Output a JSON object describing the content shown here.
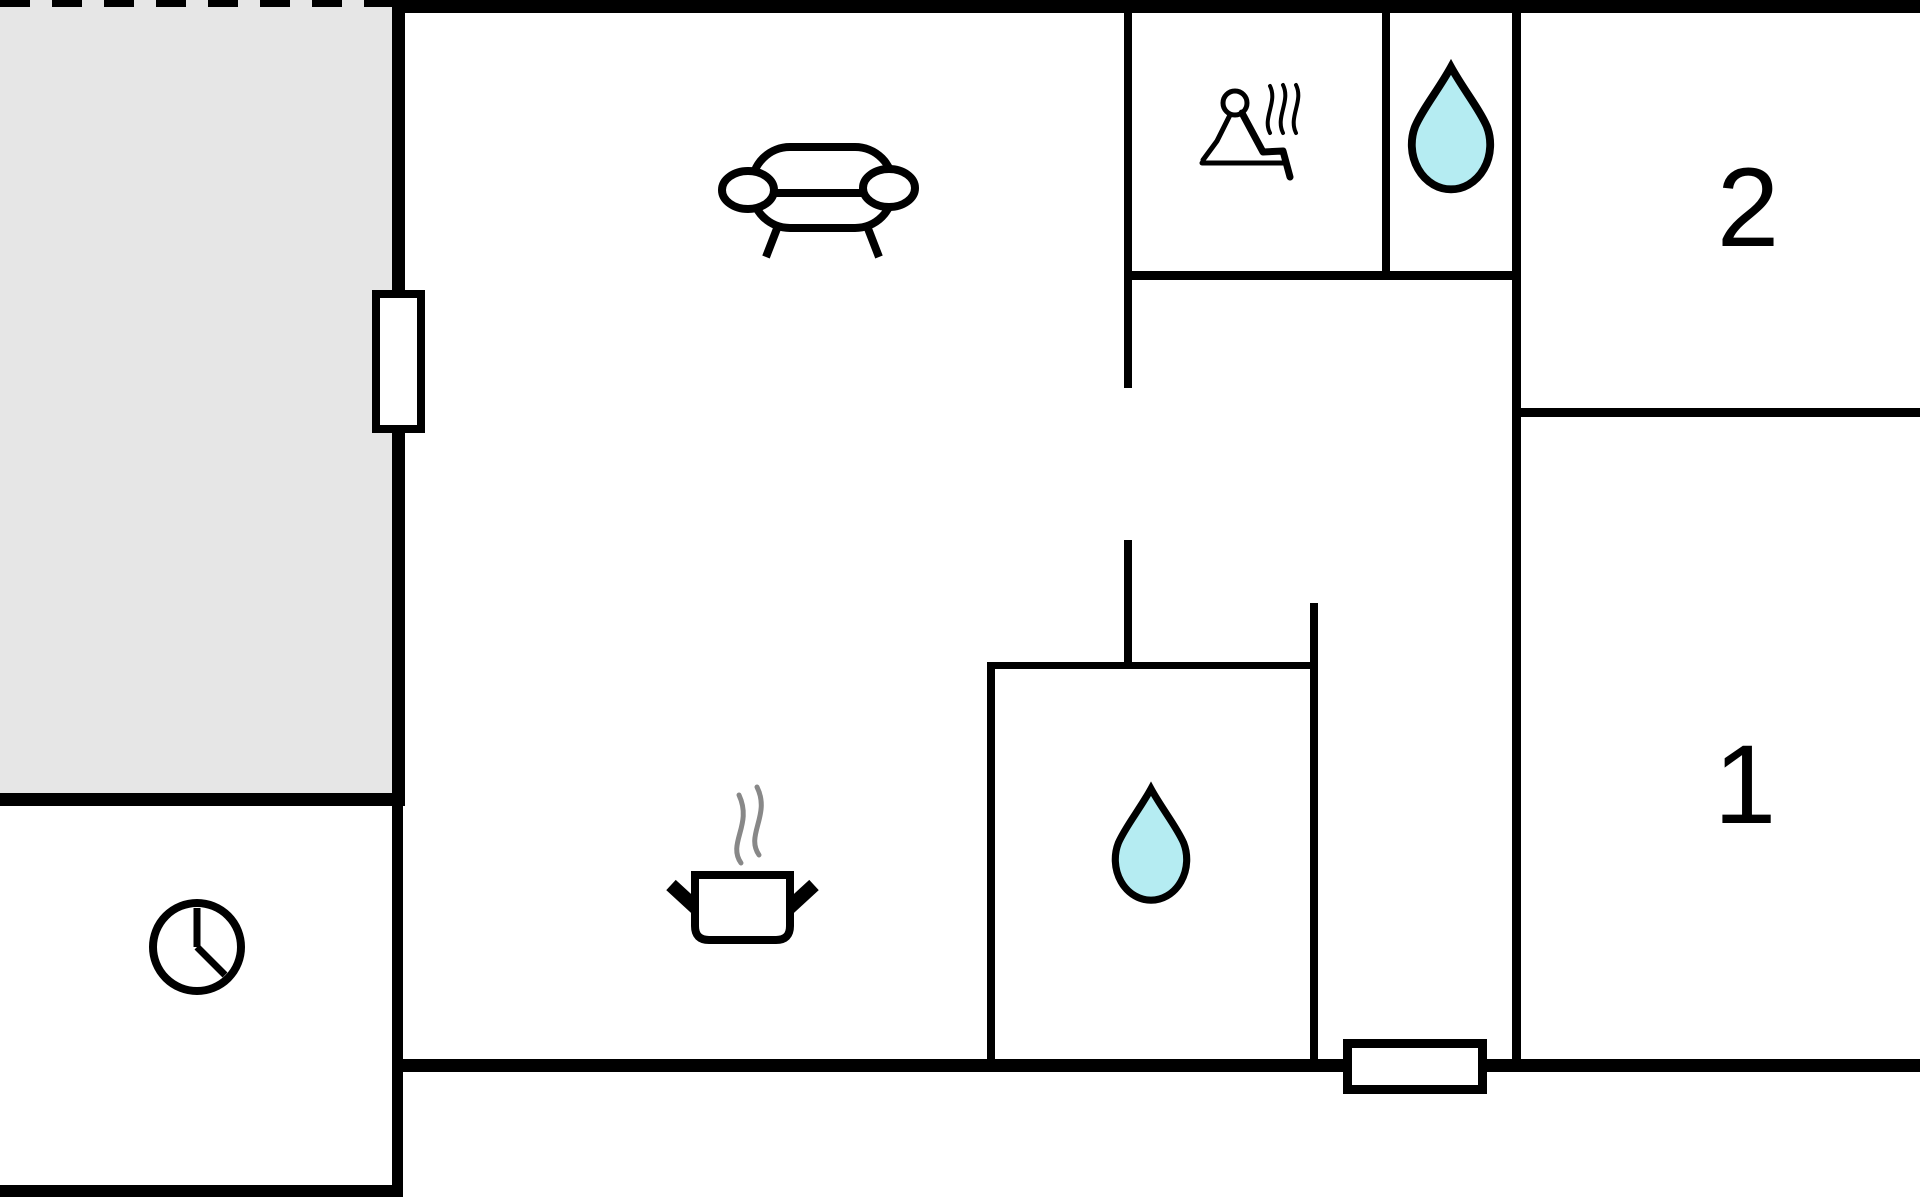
{
  "floorplan": {
    "type": "floor-plan",
    "labels": {
      "bedroom_1": "1",
      "bedroom_2": "2"
    },
    "colors": {
      "background": "#ffffff",
      "wall": "#000000",
      "terrace_fill": "#e6e6e6",
      "drop_fill": "#b5ecf2",
      "drop_stroke": "#000000",
      "steam_gray": "#888888",
      "icon_stroke": "#000000"
    },
    "icons": {
      "living_room": [
        "sofa-icon",
        "stove-pot-icon"
      ],
      "utility_room": [
        "wall-clock-icon"
      ],
      "sauna_room": [
        "sauna-person-icon"
      ],
      "wc_room": [
        "water-drop-icon"
      ],
      "bathroom": [
        "water-drop-icon"
      ],
      "terrace_edge": "dashed-property-line"
    }
  }
}
